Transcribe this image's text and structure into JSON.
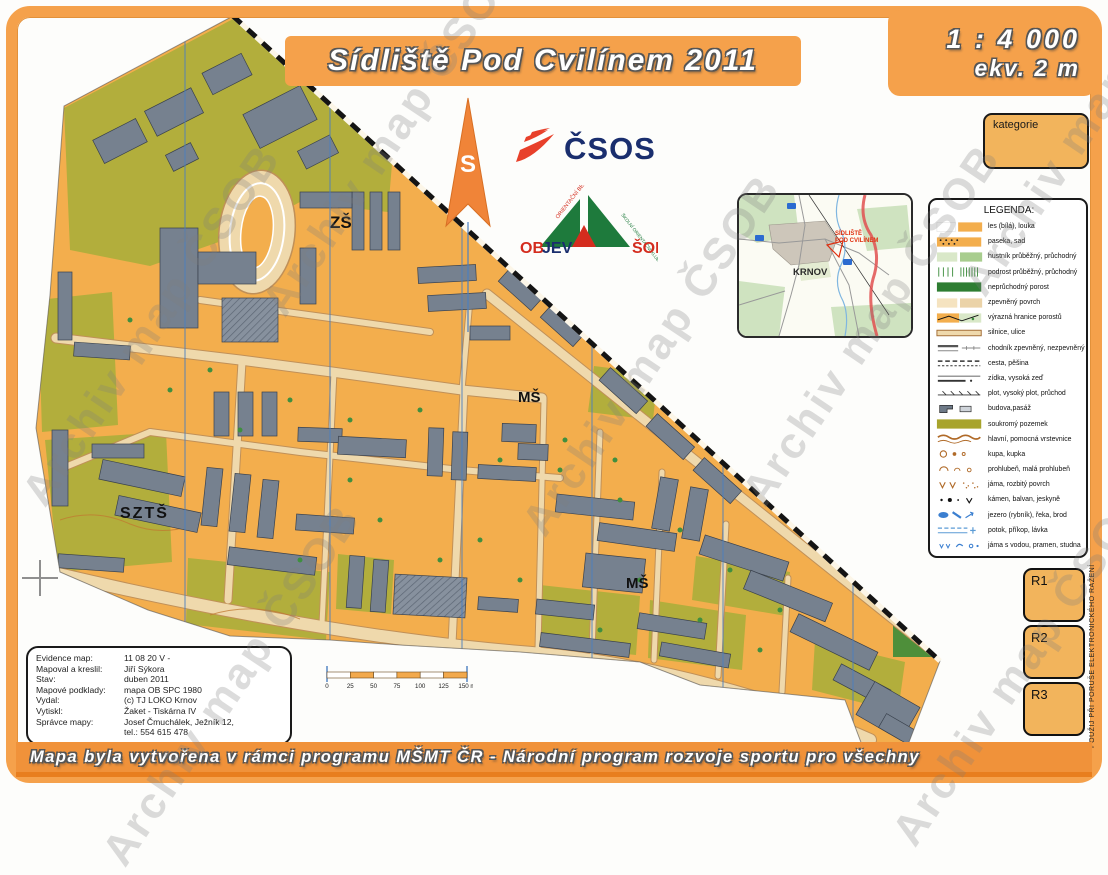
{
  "page": {
    "title": "Sídliště Pod Cvilínem 2011",
    "scale_line1": "1 : 4 000",
    "scale_line2": "ekv. 2 m",
    "banner": "Mapa byla vytvořena v rámci programu MŠMT ČR - Národní program rozvoje sportu pro všechny",
    "watermark": "Archiv map ČSOB"
  },
  "compass": {
    "label": "S"
  },
  "logos": {
    "csos": "ČSOS",
    "ob": "OB",
    "jev": "JEV",
    "sok": "ŠOK",
    "diag_left": "ORIENTAČNÍ BĚH",
    "diag_right": "ŠKOLNÍ ORIENTAČNÍ KLUBY"
  },
  "inset": {
    "city": "KRNOV",
    "site_line1": "SÍDLIŠTĚ",
    "site_line2": "POD CVILÍNEM"
  },
  "kategorie": {
    "label": "kategorie"
  },
  "legend": {
    "title": "LEGENDA:",
    "items": [
      {
        "label": "les (bílá), louka"
      },
      {
        "label": "paseka, sad"
      },
      {
        "label": "hustník průběžný, průchodný"
      },
      {
        "label": "podrost průběžný, průchodný"
      },
      {
        "label": "neprůchodný porost"
      },
      {
        "label": "zpevněný povrch"
      },
      {
        "label": "výrazná hranice porostů"
      },
      {
        "label": "silnice, ulice"
      },
      {
        "label": "chodník zpevněný, nezpevněný"
      },
      {
        "label": "cesta, pěšina"
      },
      {
        "label": "zídka, vysoká zeď"
      },
      {
        "label": "plot, vysoký plot, průchod"
      },
      {
        "label": "budova,pasáž"
      },
      {
        "label": "soukromý pozemek"
      },
      {
        "label": "hlavní, pomocná vrstevnice"
      },
      {
        "label": "kupa, kupka"
      },
      {
        "label": "prohlubeň, malá prohlubeň"
      },
      {
        "label": "jáma, rozbitý povrch"
      },
      {
        "label": "kámen, balvan, jeskyně"
      },
      {
        "label": "jezero (rybník), řeka, brod"
      },
      {
        "label": "potok, příkop, lávka"
      },
      {
        "label": "jáma s vodou, pramen, studna"
      }
    ]
  },
  "map_labels": {
    "zs": "ZŠ",
    "szts": "SZTŠ",
    "ms1": "MŠ",
    "ms2": "MŠ"
  },
  "scalebar": {
    "ticks": [
      "0",
      "25",
      "50",
      "75",
      "100",
      "125",
      "150 m"
    ]
  },
  "info": {
    "rows": [
      {
        "label": "Evidence map:",
        "value": "11 08 20 V -"
      },
      {
        "label": "Mapoval a kreslil:",
        "value": "Jiří Sýkora"
      },
      {
        "label": "Stav:",
        "value": "duben 2011"
      },
      {
        "label": "Mapové podklady:",
        "value": "mapa OB SPC 1980"
      },
      {
        "label": "Vydal:",
        "value": "(c) TJ LOKO Krnov"
      },
      {
        "label": "Vytiskl:",
        "value": "Žaket - Tiskárna IV"
      },
      {
        "label": "Správce mapy:",
        "value": "Josef Čmuchálek, Ježník 12,\ntel.: 554 615 478"
      }
    ]
  },
  "controls": {
    "r1": "R1",
    "r2": "R2",
    "r3": "R3",
    "side_note": "POUŽIJ PŘI PORUŠE ELEKTRONICKÉHO RAŽENÍ"
  },
  "colors": {
    "frame_orange": "#F5A14B",
    "map_open_orange": "#F3AE4D",
    "olive_private": "#B2AE3C",
    "building_gray": "#76818F",
    "road_tan": "#EFD9AC",
    "meridian_blue": "#4A7FC0",
    "banner_orange": "#F0923A"
  }
}
